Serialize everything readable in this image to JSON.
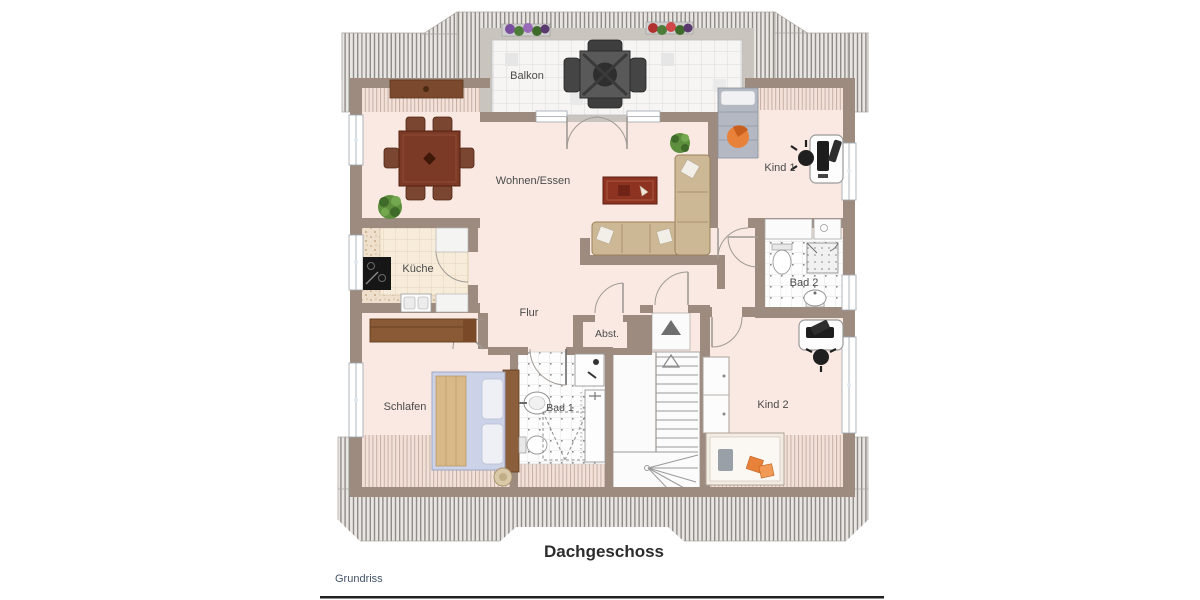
{
  "plan": {
    "rooms": {
      "balkon": {
        "label": "Balkon"
      },
      "wohnen": {
        "label": "Wohnen/Essen"
      },
      "kind1": {
        "label": "Kind 1"
      },
      "kueche": {
        "label": "Küche"
      },
      "bad2": {
        "label": "Bad 2"
      },
      "flur": {
        "label": "Flur"
      },
      "abst": {
        "label": "Abst."
      },
      "schlafen": {
        "label": "Schlafen"
      },
      "bad1": {
        "label": "Bad 1"
      },
      "kind2": {
        "label": "Kind 2"
      }
    },
    "colors": {
      "floor": "#f9e9e2",
      "wall": "#9c8b7e",
      "roof_hatch_stripe": "#8f8b87",
      "roof_hatch_bg": "#e8e5e2",
      "balcony_tile": "#f7f6f5",
      "furniture_wood": "#7b3a26",
      "sofa": "#cdb896",
      "accent_orange": "#e8813a",
      "bed_blue": "#ccd3e8"
    }
  },
  "footer": {
    "title": "Dachgeschoss",
    "caption": "Grundriss"
  }
}
